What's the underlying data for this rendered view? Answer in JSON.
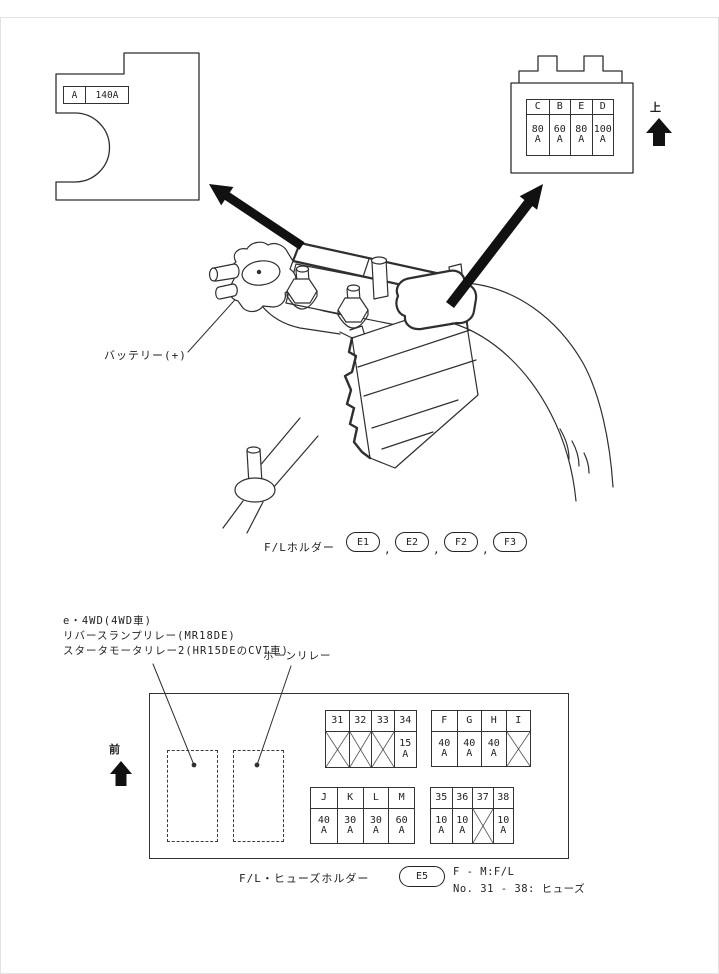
{
  "colors": {
    "ink": "#2f2f2f",
    "background": "#ffffff",
    "arrow_fill": "#111111"
  },
  "top_left_view": {
    "fuse_id": "A",
    "fuse_rating": "140A"
  },
  "top_right_view": {
    "direction_label": "上",
    "slots": [
      {
        "id": "C",
        "value": "80",
        "unit": "A"
      },
      {
        "id": "B",
        "value": "60",
        "unit": "A"
      },
      {
        "id": "E",
        "value": "80",
        "unit": "A"
      },
      {
        "id": "D",
        "value": "100",
        "unit": "A"
      }
    ]
  },
  "center": {
    "battery_label": "バッテリー(+)",
    "holder_label": "F/Lホルダー",
    "holder_refs": [
      "E1",
      "E2",
      "F2",
      "F3"
    ],
    "separator": ","
  },
  "bottom_view": {
    "callouts": {
      "relay_lines": [
        "e・4WD(4WD車)",
        "リバースランプリレー(MR18DE)",
        "スタータモータリレー2(HR15DEのCVT車)"
      ],
      "horn_relay": "ホーンリレー"
    },
    "direction_label": "前",
    "tables": [
      {
        "name": "fuses-31-34",
        "slots": [
          {
            "id": "31",
            "blocked": true
          },
          {
            "id": "32",
            "blocked": true
          },
          {
            "id": "33",
            "blocked": true
          },
          {
            "id": "34",
            "value": "15",
            "unit": "A"
          }
        ]
      },
      {
        "name": "links-F-I",
        "slots": [
          {
            "id": "F",
            "value": "40",
            "unit": "A"
          },
          {
            "id": "G",
            "value": "40",
            "unit": "A"
          },
          {
            "id": "H",
            "value": "40",
            "unit": "A"
          },
          {
            "id": "I",
            "blocked": true
          }
        ]
      },
      {
        "name": "links-J-M",
        "slots": [
          {
            "id": "J",
            "value": "40",
            "unit": "A"
          },
          {
            "id": "K",
            "value": "30",
            "unit": "A"
          },
          {
            "id": "L",
            "value": "30",
            "unit": "A"
          },
          {
            "id": "M",
            "value": "60",
            "unit": "A"
          }
        ]
      },
      {
        "name": "fuses-35-38",
        "slots": [
          {
            "id": "35",
            "value": "10",
            "unit": "A"
          },
          {
            "id": "36",
            "value": "10",
            "unit": "A"
          },
          {
            "id": "37",
            "blocked": true
          },
          {
            "id": "38",
            "value": "10",
            "unit": "A"
          }
        ]
      }
    ],
    "holder_label": "F/L・ヒューズホルダー",
    "holder_ref": "E5",
    "notes": [
      "F - M:F/L",
      "No. 31 - 38: ヒューズ"
    ]
  }
}
